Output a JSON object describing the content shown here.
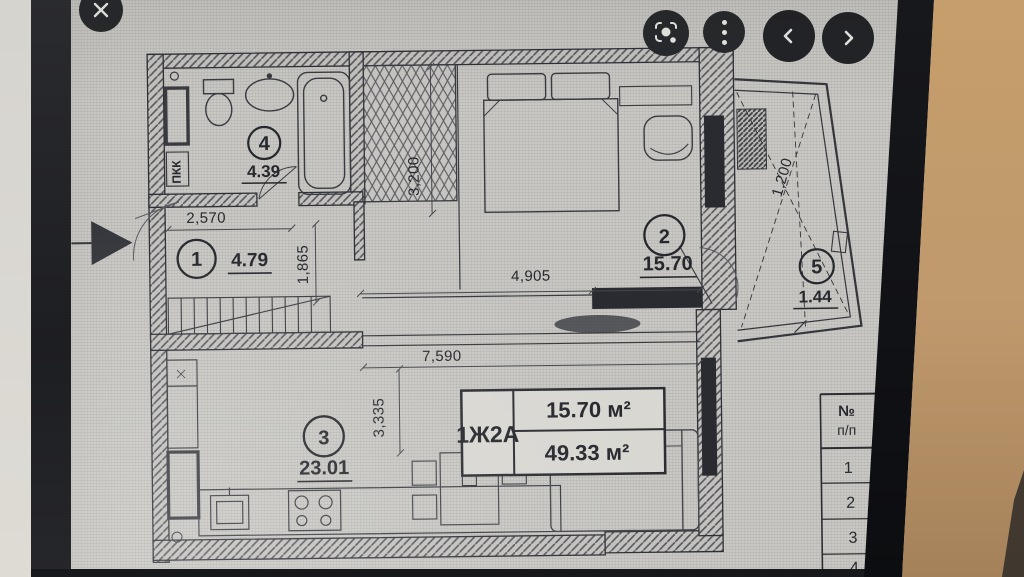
{
  "colors": {
    "screen": "#c9c8c4",
    "bezel": "#1b1c20",
    "wall_tan": "#c19a6b",
    "ink": "#2b2c31"
  },
  "viewer": {
    "buttons": [
      {
        "name": "close-button",
        "icon": "close-icon"
      },
      {
        "name": "lens-button",
        "icon": "lens-scan-icon"
      },
      {
        "name": "menu-button",
        "icon": "three-dot-menu-icon"
      },
      {
        "name": "prev-button",
        "icon": "chevron-left-icon"
      },
      {
        "name": "next-button",
        "icon": "chevron-right-icon"
      }
    ]
  },
  "plan": {
    "rooms": [
      {
        "num": "1",
        "area": "4.79"
      },
      {
        "num": "2",
        "area": "15.70"
      },
      {
        "num": "3",
        "area": "23.01"
      },
      {
        "num": "4",
        "area": "4.39"
      },
      {
        "num": "5",
        "area": "1.44"
      }
    ],
    "dims": {
      "hall_width": "2,570",
      "hall_depth": "1,865",
      "closet_height": "3,200",
      "bedroom_width": "4,905",
      "living_width": "7,590",
      "living_depth": "3,335",
      "balcony_depth": "1,200"
    },
    "riser_label": "ПКК",
    "unit_table": {
      "code": "1Ж2А",
      "living_area": "15.70 м²",
      "total_area": "49.33 м²"
    },
    "legend_table": {
      "header_top": "№",
      "header_bottom": "п/п",
      "rows": [
        "1",
        "2",
        "3",
        "4"
      ]
    }
  }
}
